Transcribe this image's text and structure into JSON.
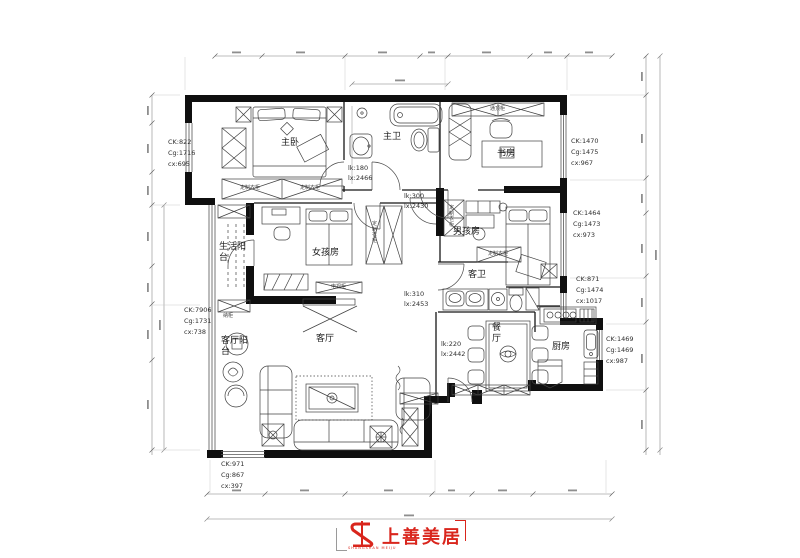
{
  "drawing": {
    "type": "apartment-floor-plan"
  },
  "rooms": [
    {
      "id": "master-bedroom",
      "label": "主卧"
    },
    {
      "id": "master-bath",
      "label": "主卫"
    },
    {
      "id": "study",
      "label": "书房"
    },
    {
      "id": "boys-room",
      "label": "男孩房"
    },
    {
      "id": "girls-room",
      "label": "女孩房"
    },
    {
      "id": "living-balcony",
      "label": "生活阳台"
    },
    {
      "id": "living-room-balcony",
      "label": "客厅阳台"
    },
    {
      "id": "living-room",
      "label": "客厅"
    },
    {
      "id": "guest-bath",
      "label": "客卫"
    },
    {
      "id": "dining-room",
      "label": "餐厅"
    },
    {
      "id": "kitchen",
      "label": "厨房"
    }
  ],
  "window_annotations": [
    {
      "ck": "CK:822",
      "cg": "Cg:1716",
      "cx": "cx:695"
    },
    {
      "ck": "CK:7906",
      "cg": "Cg:1731",
      "cx": "cx:738"
    },
    {
      "ck": "CK:971",
      "cg": "Cg:867",
      "cx": "cx:397"
    },
    {
      "ck": "CK:1470",
      "cg": "Cg:1475",
      "cx": "cx:967"
    },
    {
      "ck": "CK:1464",
      "cg": "Cg:1473",
      "cx": "cx:973"
    },
    {
      "ck": "CK:871",
      "cg": "Cg:1474",
      "cx": "cx:1017"
    },
    {
      "ck": "CK:1469",
      "cg": "Cg:1469",
      "cx": "cx:987"
    }
  ],
  "opening_annotations": [
    {
      "lk": "lk:180",
      "lx": "lx:2466"
    },
    {
      "lk": "lk:300",
      "lx": "lx:2430"
    },
    {
      "lk": "lk:310",
      "lx": "lx:2453"
    },
    {
      "lk": "lk:220",
      "lx": "lx:2442"
    }
  ],
  "furniture_labels": [
    {
      "text": "定制衣柜"
    },
    {
      "text": "定制衣柜"
    },
    {
      "text": "定制衣柜"
    },
    {
      "text": "定制衣柜"
    },
    {
      "text": "定制衣柜"
    },
    {
      "text": "纳柜"
    },
    {
      "text": "电视柜"
    },
    {
      "text": "通顶柜"
    }
  ],
  "logo": {
    "brand": "上善美居",
    "sub": "SHANGSHAN MEIJU",
    "color": "#d9251c"
  }
}
